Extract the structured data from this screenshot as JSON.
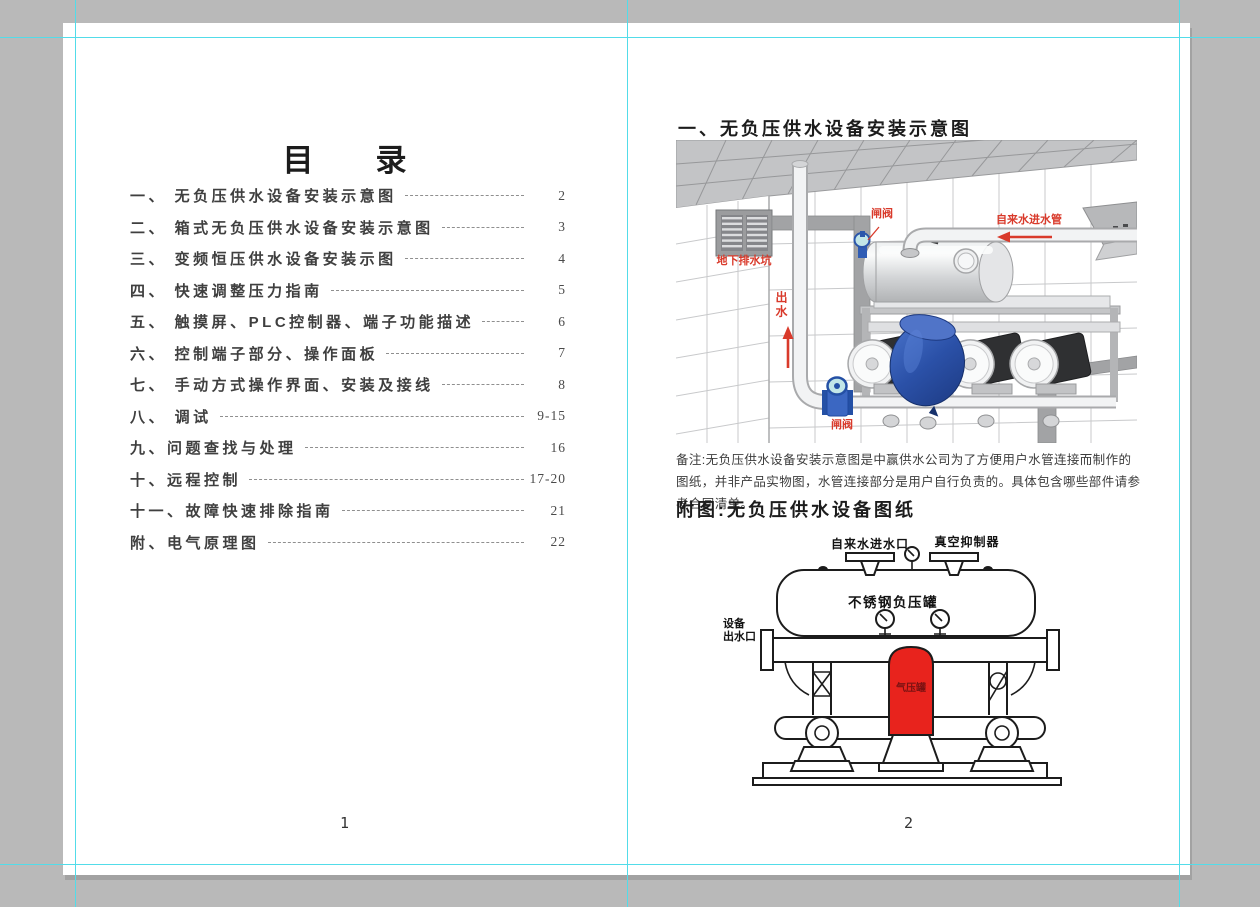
{
  "app": {
    "pasteboard_color": "#b9b9b9",
    "guide_color": "#52dce9",
    "page_color": "#ffffff"
  },
  "left_page": {
    "title": "目　　录",
    "page_number": "1",
    "toc": [
      {
        "label": "一、 无负压供水设备安装示意图",
        "page": "2"
      },
      {
        "label": "二、 箱式无负压供水设备安装示意图",
        "page": "3"
      },
      {
        "label": "三、 变频恒压供水设备安装示图",
        "page": "4"
      },
      {
        "label": "四、 快速调整压力指南",
        "page": "5"
      },
      {
        "label": "五、 触摸屏、PLC控制器、端子功能描述",
        "page": "6"
      },
      {
        "label": "六、 控制端子部分、操作面板",
        "page": "7"
      },
      {
        "label": "七、 手动方式操作界面、安装及接线",
        "page": "8"
      },
      {
        "label": "八、 调试",
        "page": "9-15"
      },
      {
        "label": "九、问题查找与处理",
        "page": "16"
      },
      {
        "label": "十、远程控制",
        "page": "17-20"
      },
      {
        "label": "十一、故障快速排除指南",
        "page": "21"
      },
      {
        "label": "附、电气原理图",
        "page": "22"
      }
    ]
  },
  "right_page": {
    "section_title": "一、无负压供水设备安装示意图",
    "page_number": "2",
    "installation_diagram": {
      "label_gate_valve_top": "闸阀",
      "label_tap_water_inlet_pipe": "自来水进水管",
      "label_underground_drain_pit": "地下排水坑",
      "label_water_outlet": "出水",
      "label_gate_valve_bottom": "闸阀"
    },
    "note": "备注:无负压供水设备安装示意图是中赢供水公司为了方便用户水管连接而制作的图纸，并非产品实物图，水管连接部分是用户自行负责的。具体包含哪些部件请参考合同清单。",
    "attachment_title": "附图:无负压供水设备图纸",
    "equipment_drawing": {
      "label_tap_water_inlet": "自来水进水口",
      "label_vacuum_suppressor": "真空抑制器",
      "label_tank": "不锈钢负压罐",
      "label_outlet_line1": "设备",
      "label_outlet_line2": "出水口",
      "label_air_tank": "气压罐"
    }
  }
}
